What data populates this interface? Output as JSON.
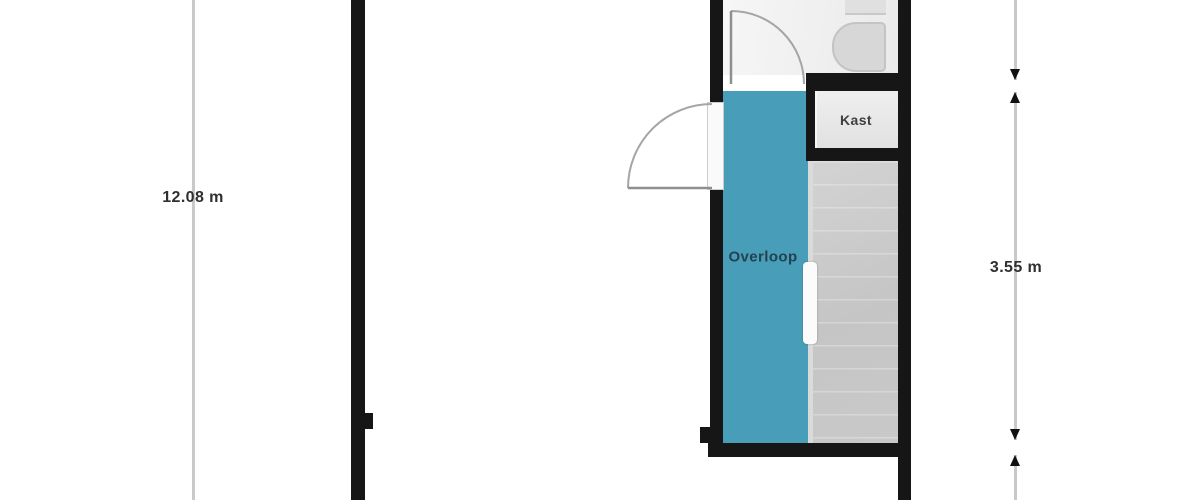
{
  "plan": {
    "rooms": {
      "overloop": {
        "label": "Overloop",
        "color": "#489eb8"
      },
      "kast": {
        "label": "Kast",
        "color": "#e9e9e9"
      },
      "bathroom": {
        "color": "#f1f1f1"
      },
      "stairs": {
        "color": "#c7c7c7"
      }
    },
    "fixtures": {
      "toilet_icon": "toilet"
    },
    "wall_color": "#161616",
    "door_arc_color": "#a5a5a5"
  },
  "dimensions": {
    "left": {
      "label": "12.08 m"
    },
    "right": {
      "label": "3.55 m"
    },
    "line_color": "#c9c9c9"
  }
}
